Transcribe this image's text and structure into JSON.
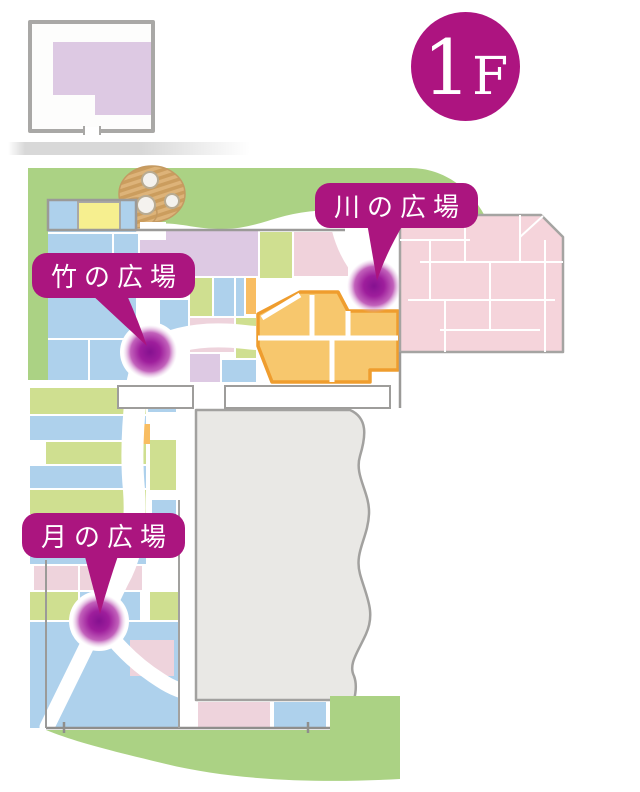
{
  "floor_badge": {
    "number": "1",
    "suffix": "F"
  },
  "plazas": [
    {
      "id": "kawa",
      "label": "川の広場"
    },
    {
      "id": "take",
      "label": "竹の広場"
    },
    {
      "id": "tsuki",
      "label": "月の広場"
    }
  ],
  "palette": {
    "accent_magenta": "#ab157f",
    "marker_purple": "#8e1693",
    "lawn_green": "#abd284",
    "room_blue": "#aed1ec",
    "room_green": "#cfdf90",
    "room_pink": "#f0d2db",
    "room_lavender": "#ddc9e3",
    "room_yellow": "#f6ef8f",
    "event_orange_fill": "#f7c76d",
    "event_orange_border": "#ef9d2e",
    "big_pink_block": "#f5d4db",
    "courtyard_gray": "#e9e8e5",
    "wall_gray": "#9b9a98",
    "garden_tan": "#d9ae74"
  }
}
